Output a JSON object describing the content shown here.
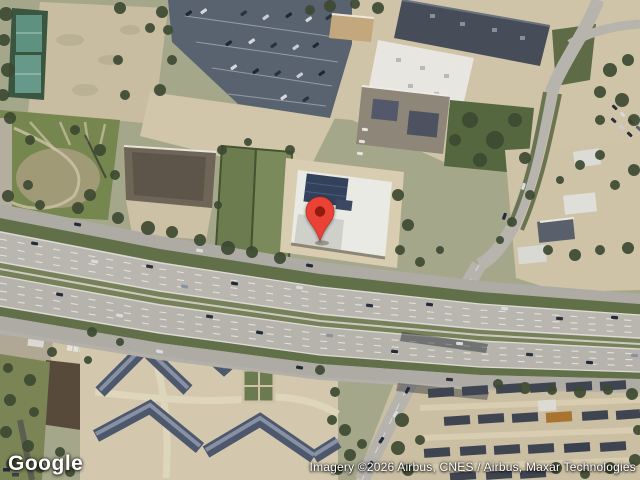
{
  "map": {
    "view_type": "satellite",
    "logo_text": "Google",
    "attribution_text": "Imagery ©2026 Airbus, CNES / Airbus, Maxar Technologies",
    "marker": {
      "label": "location-pin",
      "color": "#EA4335",
      "inner_color": "#8E1B0E",
      "x": 320,
      "y": 241
    },
    "palette": {
      "highway_asphalt": "#b5b3ab",
      "grass_median": "#62704a",
      "parking_lot": "#59636f",
      "dirt_field": "#c9bda1",
      "dark_roof": "#4e586c",
      "white_roof": "#e9eae4",
      "tree_canopy": "#3d4a32"
    }
  }
}
